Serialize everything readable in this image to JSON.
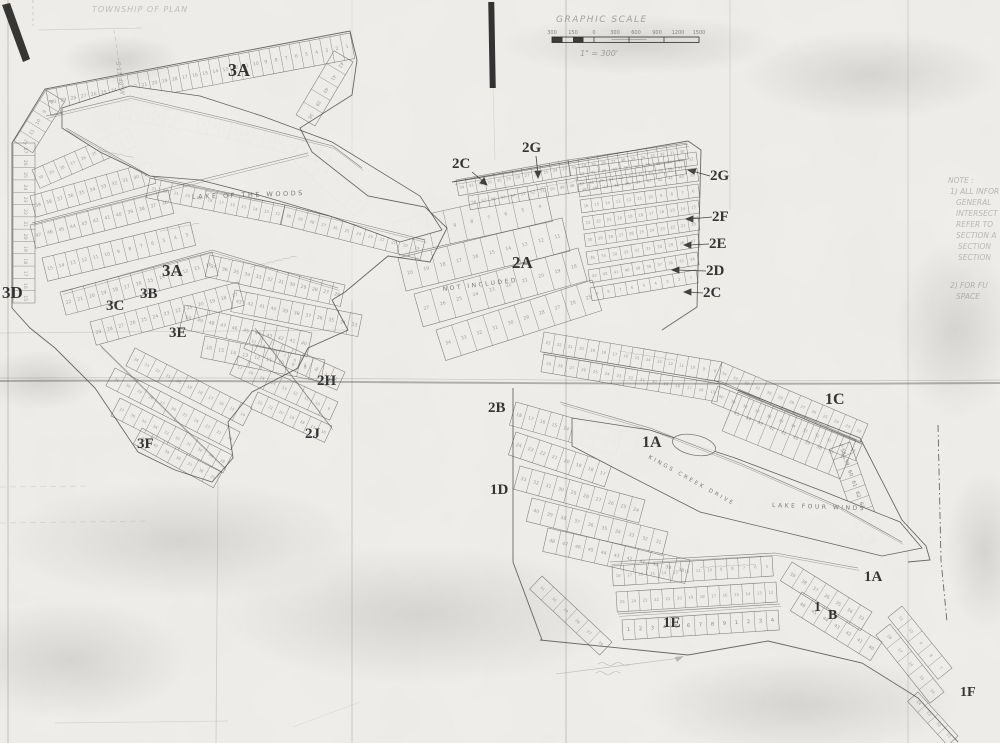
{
  "scale_bar": {
    "title": "GRAPHIC SCALE",
    "ticks": [
      "300",
      "150",
      "0",
      "300",
      "600",
      "900",
      "1200",
      "1500"
    ],
    "caption": "1\" = 300'"
  },
  "corner_note": "TOWNSHIP OF PLAN",
  "bearing_note": "S 11°48' W",
  "side_notes": [
    "NOTE :",
    "1) ALL INFOR",
    "GENERAL",
    "INTERSECT",
    "REFER TO",
    "SECTION A",
    "SECTION",
    "SECTION",
    "",
    "2) FOR FU",
    "SPACE"
  ],
  "lakes": {
    "upper": "LAKE OF THE WOODS",
    "lower": "LAKE FOUR WINDS"
  },
  "area_notes": {
    "not_included": "NOT INCLUDED"
  },
  "roads": {
    "kings_creek": "KINGS CREEK DRIVE"
  },
  "section_labels": {
    "s3a_top": "3A",
    "s2c_top": "2C",
    "s2g_top": "2G",
    "s2g_right": "2G",
    "s2f_right": "2F",
    "s2e_right": "2E",
    "s2d_right": "2D",
    "s2c_right": "2C",
    "s2a": "2A",
    "s3a_mid": "3A",
    "s3b": "3B",
    "s3c": "3C",
    "s3d": "3D",
    "s3e": "3E",
    "s3f": "3F",
    "s2h": "2H",
    "s2j": "2J",
    "s2b": "2B",
    "s1d": "1D",
    "s1c": "1C",
    "s1a_mid": "1A",
    "s1a_right": "1A",
    "s1": "1",
    "sb": "B",
    "s1e": "1E",
    "s1f": "1F"
  },
  "lot_sequences": {
    "east_strip": [
      "58",
      "59",
      "60",
      "61",
      "62",
      "63",
      "64",
      "65",
      "66",
      "67"
    ],
    "bottom_row": [
      "1",
      "2",
      "3",
      "4",
      "5",
      "6",
      "7",
      "8",
      "9"
    ]
  }
}
